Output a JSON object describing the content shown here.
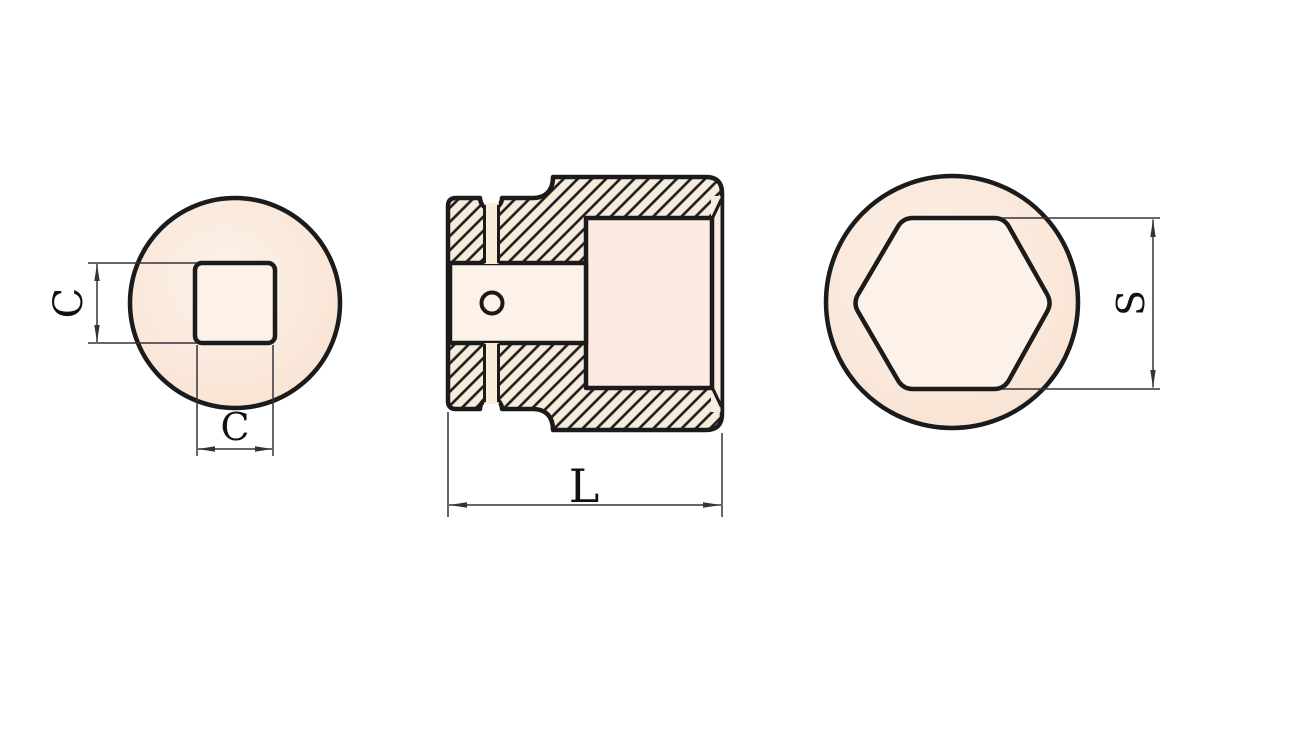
{
  "figure": {
    "type": "technical-drawing",
    "subject": "impact-socket-three-views",
    "labels": {
      "square_height": "C",
      "square_width": "C",
      "overall_length": "L",
      "across_flats": "S"
    },
    "views": [
      {
        "id": "square-drive-end-view",
        "position": "left",
        "features": [
          "outer-circle",
          "square-drive-hole"
        ],
        "dimensions": [
          "C vertical",
          "C horizontal"
        ]
      },
      {
        "id": "section-view",
        "position": "center",
        "features": [
          "hatched-cross-section",
          "ring-groove",
          "pin-hole",
          "square-drive-cavity",
          "hex-opening-cavity"
        ],
        "dimensions": [
          "L horizontal"
        ]
      },
      {
        "id": "hex-opening-end-view",
        "position": "right",
        "features": [
          "outer-circle",
          "hexagon-socket-opening"
        ],
        "dimensions": [
          "S vertical"
        ]
      }
    ]
  },
  "colors": {
    "background": "#ffffff",
    "body_fill": "#fcebe1",
    "body_fill_light": "#fdf2ea",
    "body_fill_dark": "#f8e1cf",
    "hatch_fill": "#f6ecdc",
    "groove_fill": "#faeeda",
    "outline": "#1b1b1b",
    "dimension": "#33333b"
  }
}
